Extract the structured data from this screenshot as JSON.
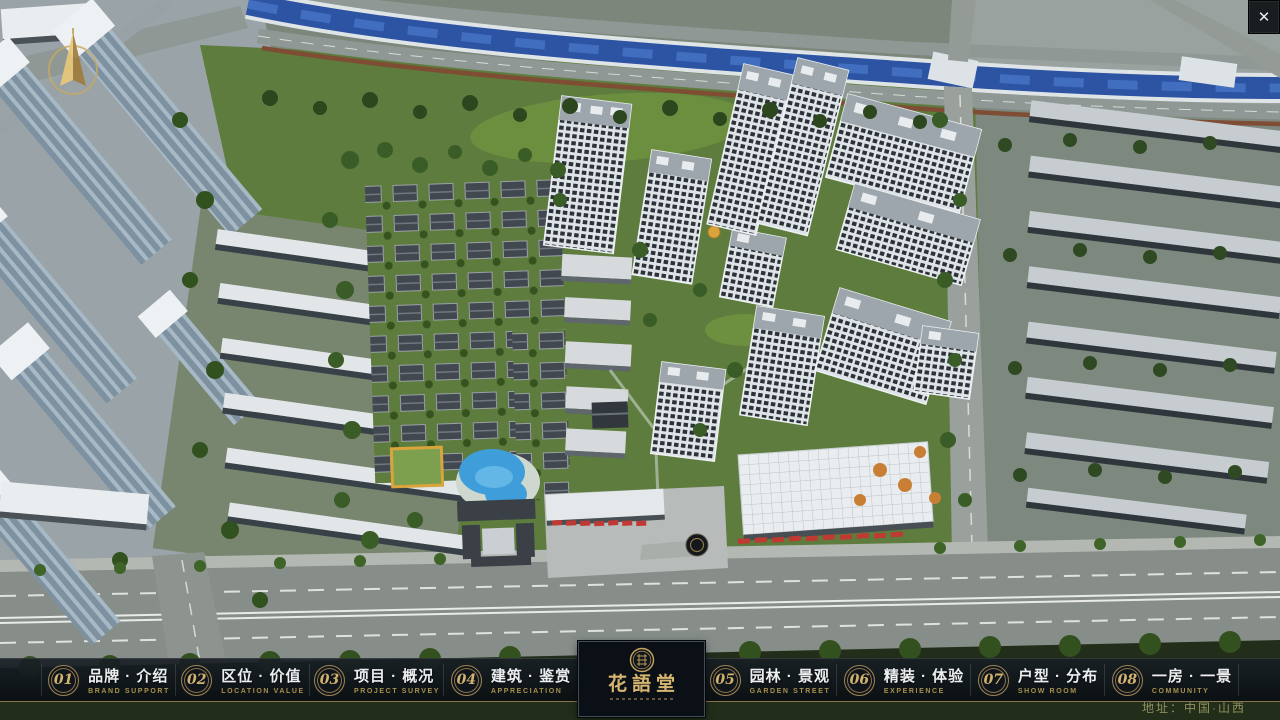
{
  "chrome": {
    "close_glyph": "✕"
  },
  "navbar": {
    "items": [
      {
        "num": "01",
        "zh": "品牌 · 介绍",
        "en": "BRAND SUPPORT"
      },
      {
        "num": "02",
        "zh": "区位 · 价值",
        "en": "LOCATION VALUE"
      },
      {
        "num": "03",
        "zh": "项目 · 概况",
        "en": "PROJECT SURVEY"
      },
      {
        "num": "04",
        "zh": "建筑 · 鉴赏",
        "en": "APPRECIATION"
      },
      {
        "num": "05",
        "zh": "园林 · 景观",
        "en": "GARDEN STREET"
      },
      {
        "num": "06",
        "zh": "精装 · 体验",
        "en": "EXPERIENCE"
      },
      {
        "num": "07",
        "zh": "户型 · 分布",
        "en": "SHOW ROOM"
      },
      {
        "num": "08",
        "zh": "一房 · 一景",
        "en": "COMMUNITY"
      }
    ]
  },
  "logo": {
    "title": "花語堂"
  },
  "footer": {
    "address": "地址：中国·山西"
  },
  "colors": {
    "gold": "#bfa05e",
    "navbar_bg": "rgba(14,19,25,0.88)",
    "river_blue": "#2d53a3",
    "greenery": "#5d7c3d",
    "road_gray": "#8e9591"
  }
}
